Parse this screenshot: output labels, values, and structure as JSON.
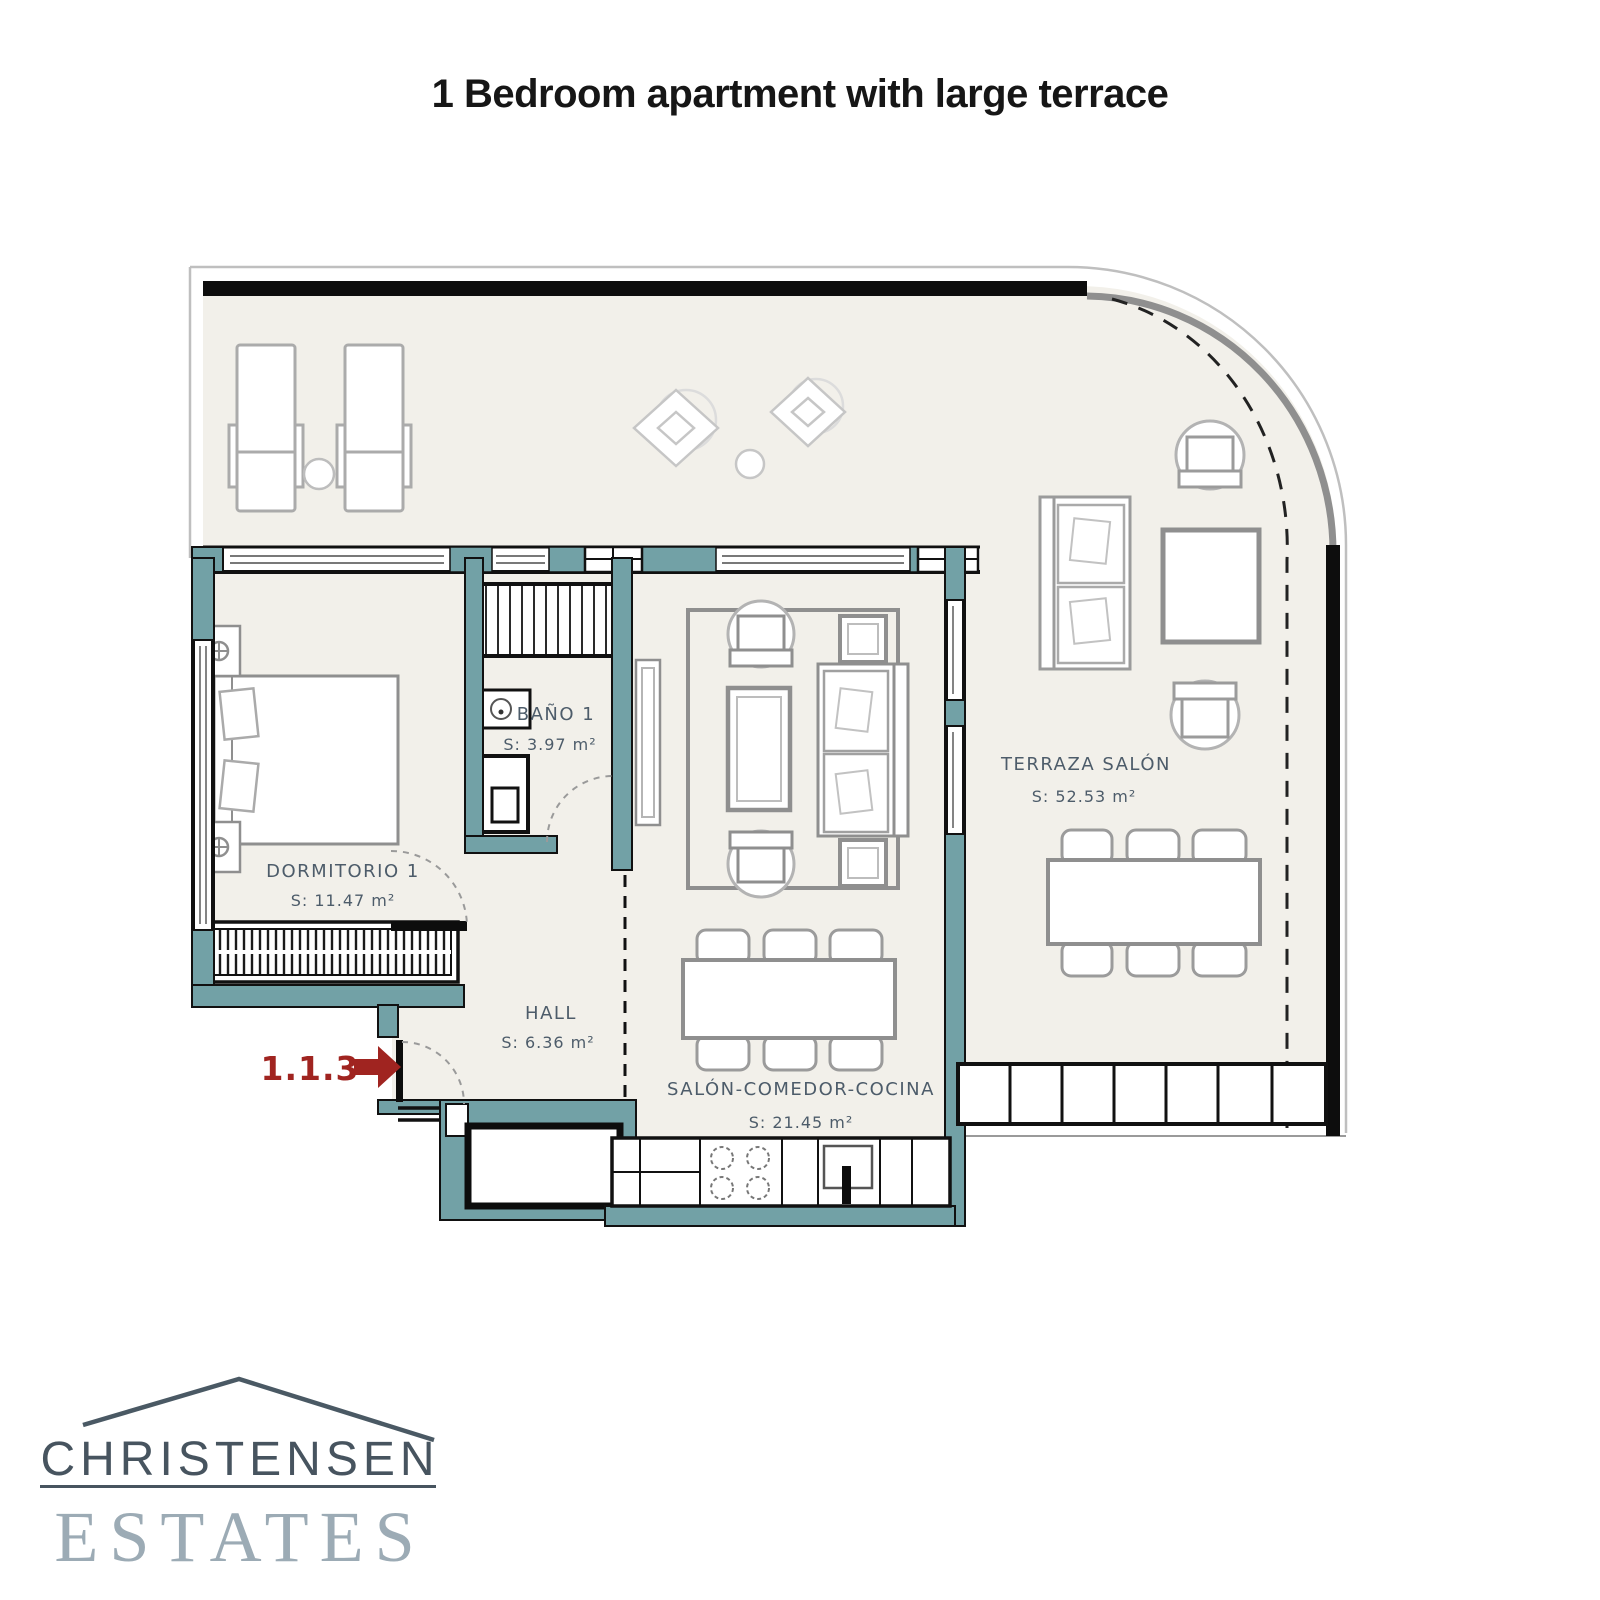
{
  "title": "1 Bedroom apartment with large terrace",
  "unit_marker": {
    "number": "1.1.3",
    "arrow_icon": "entrance-arrow-icon"
  },
  "rooms": {
    "dormitorio": {
      "name": "DORMITORIO 1",
      "area": "S: 11.47 m²"
    },
    "bano": {
      "name": "BAÑO 1",
      "area": "S: 3.97 m²"
    },
    "hall": {
      "name": "HALL",
      "area": "S: 6.36 m²"
    },
    "salon": {
      "name": "SALÓN-COMEDOR-COCINA",
      "area": "S: 21.45 m²"
    },
    "terraza": {
      "name": "TERRAZA SALÓN",
      "area": "S: 52.53 m²"
    }
  },
  "logo": {
    "name": "CHRISTENSEN",
    "type": "ESTATES"
  },
  "colors": {
    "wall_teal": "#72a1a6",
    "wall_black": "#0d0d0d",
    "floor": "#f2f0ea",
    "accent_red": "#a02420",
    "label_text": "#4d5c6a",
    "logo_dark": "#47545f",
    "logo_light": "#9cabb5"
  }
}
